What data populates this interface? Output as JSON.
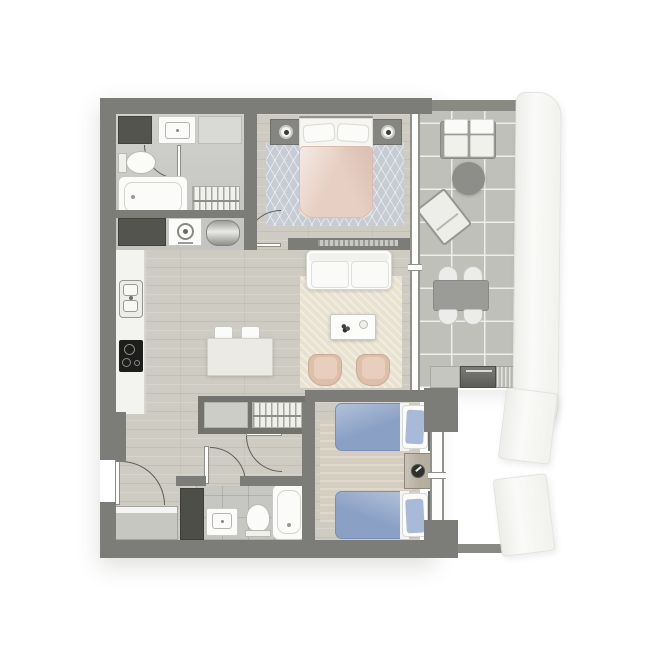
{
  "title": "Two-bedroom apartment floor plan with balcony (top-down render, no text labels)",
  "plan_type": "architectural-floor-plan",
  "palette": {
    "wall": "#7c7c78",
    "wall_dark": "#54544e",
    "wood_floor": "#cecbc2",
    "bath_tile": "#c9c9c5",
    "balcony_tile": "#bfc0ba",
    "fixture_white": "#fbfbf9",
    "duvet_pink": "#e7cfc3",
    "duvet_blue": "#8aa0c5",
    "pillow_blue": "#a9bad8",
    "rug_master": "#c7ccd4",
    "rug_living": "#e9e2d1",
    "rug_bedroom2": "#d5cec0",
    "armchair_pink": "#dcc0ac",
    "facade_white": "#f5f5f2",
    "cooktop_black": "#1d1d1b"
  },
  "rooms": [
    {
      "id": "master-bathroom",
      "label": "Master bathroom & laundry",
      "furniture": [
        "dark vanity cabinet",
        "washbasin",
        "shelf unit",
        "toilet",
        "bathtub",
        "wardrobe with hangers",
        "storage cabinet",
        "washing machine",
        "water heater"
      ]
    },
    {
      "id": "master-bedroom",
      "label": "Master bedroom",
      "furniture": [
        "double bed with pink duvet",
        "two pillows",
        "nightstand with lamp (left)",
        "nightstand with lamp (right)",
        "patterned blue-grey rug"
      ]
    },
    {
      "id": "kitchen",
      "label": "Kitchen",
      "furniture": [
        "counter run",
        "double-bowl sink",
        "black cooktop"
      ]
    },
    {
      "id": "dining",
      "label": "Dining area",
      "furniture": [
        "dining table",
        "four white chairs"
      ]
    },
    {
      "id": "living",
      "label": "Living room",
      "furniture": [
        "white two-seat sofa",
        "coffee table with decor",
        "two pink armchairs",
        "cream rug"
      ]
    },
    {
      "id": "hallway",
      "label": "Hallway / entry",
      "furniture": [
        "hall closet with shelves",
        "hall closet with hangers",
        "entry console",
        "tall dark cabinet"
      ]
    },
    {
      "id": "bathroom2",
      "label": "Second bathroom",
      "furniture": [
        "washbasin",
        "toilet",
        "bathtub"
      ]
    },
    {
      "id": "bedroom2",
      "label": "Second bedroom",
      "furniture": [
        "twin bed (top) with blue duvet",
        "twin bed (bottom) with blue duvet",
        "nightstand with lamp",
        "beige rug"
      ]
    },
    {
      "id": "balcony",
      "label": "Balcony / terrace",
      "furniture": [
        "outdoor two-seat sofa",
        "round side table",
        "angled lounge chair",
        "outdoor dining table",
        "four outdoor chairs",
        "barbecue counter with grill"
      ]
    }
  ],
  "openings": {
    "door_arcs": 5,
    "windows": [
      "living-room window wall",
      "bedroom2 window"
    ],
    "entry": "left wall, lower section"
  },
  "exterior": {
    "facade_elements": [
      "curved white facade band right of balcony",
      "white facade panel upper",
      "white facade panel lower"
    ]
  }
}
